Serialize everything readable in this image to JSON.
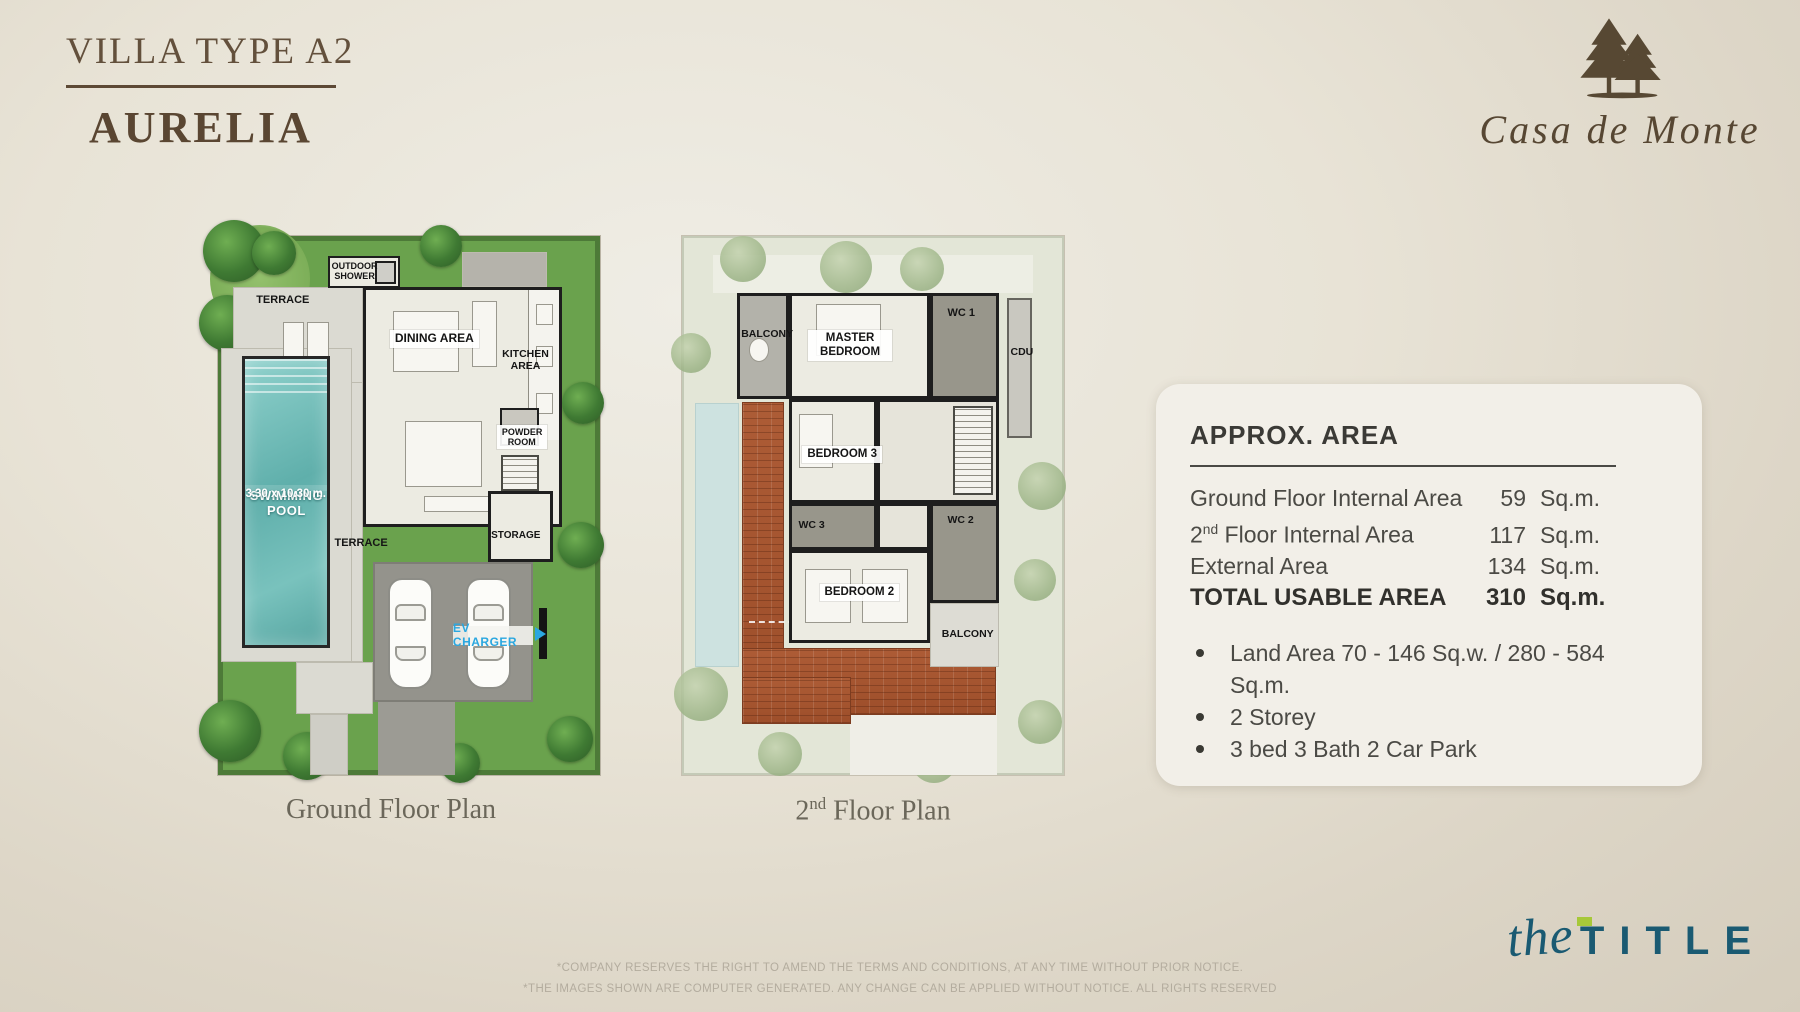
{
  "page": {
    "title_line1": "VILLA TYPE A2",
    "title_line2": "AURELIA",
    "brand_name": "Casa de Monte"
  },
  "ground_plan": {
    "caption": "Ground Floor Plan",
    "labels": {
      "outdoor_shower": "OUTDOOR SHOWER",
      "terrace_upper": "TERRACE",
      "dining": "DINING AREA",
      "kitchen": "KITCHEN AREA",
      "powder": "POWDER ROOM",
      "pool_name": "SWIMMING POOL",
      "pool_size": "3.30 x 10.30 m.",
      "terrace_lower": "TERRACE",
      "storage": "STORAGE",
      "ev_charger": "EV CHARGER"
    }
  },
  "second_plan": {
    "caption_pre": "2",
    "caption_sup": "nd",
    "caption_post": " Floor Plan",
    "labels": {
      "balcony_top": "BALCONY",
      "master_bedroom": "MASTER BEDROOM",
      "wc1": "WC 1",
      "cdu": "CDU",
      "bedroom3": "BEDROOM 3",
      "wc3": "WC 3",
      "wc2": "WC 2",
      "bedroom2": "BEDROOM 2",
      "balcony_bottom": "BALCONY"
    }
  },
  "area_panel": {
    "heading": "APPROX. AREA",
    "rows": [
      {
        "label": "Ground Floor Internal Area",
        "value": "59",
        "unit": "Sq.m."
      },
      {
        "label_pre": "2",
        "label_sup": "nd",
        "label_post": " Floor Internal Area",
        "value": "117",
        "unit": "Sq.m."
      },
      {
        "label": "External Area",
        "value": "134",
        "unit": "Sq.m."
      },
      {
        "label": "TOTAL USABLE AREA",
        "value": "310",
        "unit": "Sq.m."
      }
    ],
    "bullets": [
      "Land Area 70 - 146 Sq.w. / 280 - 584 Sq.m.",
      "2 Storey",
      "3 bed 3 Bath 2 Car Park"
    ]
  },
  "footer": {
    "disclaimer_line1": "*COMPANY RESERVES THE RIGHT TO AMEND THE TERMS AND CONDITIONS, AT ANY TIME WITHOUT PRIOR NOTICE.",
    "disclaimer_line2": "*THE IMAGES SHOWN ARE COMPUTER GENERATED. ANY CHANGE CAN BE APPLIED WITHOUT NOTICE. ALL RIGHTS RESERVED",
    "logo_script": "the",
    "logo_word": "TITLE"
  },
  "colors": {
    "brand_brown": "#5d4935",
    "title_teal": "#1a5a72",
    "title_green_accent": "#a7c839",
    "ev_blue": "#2aa7e0",
    "pool_teal": "#6fbdb8",
    "grass_green": "#6aa24d",
    "roof_terracotta": "#a85a33",
    "panel_bg": "#f2efe8"
  }
}
